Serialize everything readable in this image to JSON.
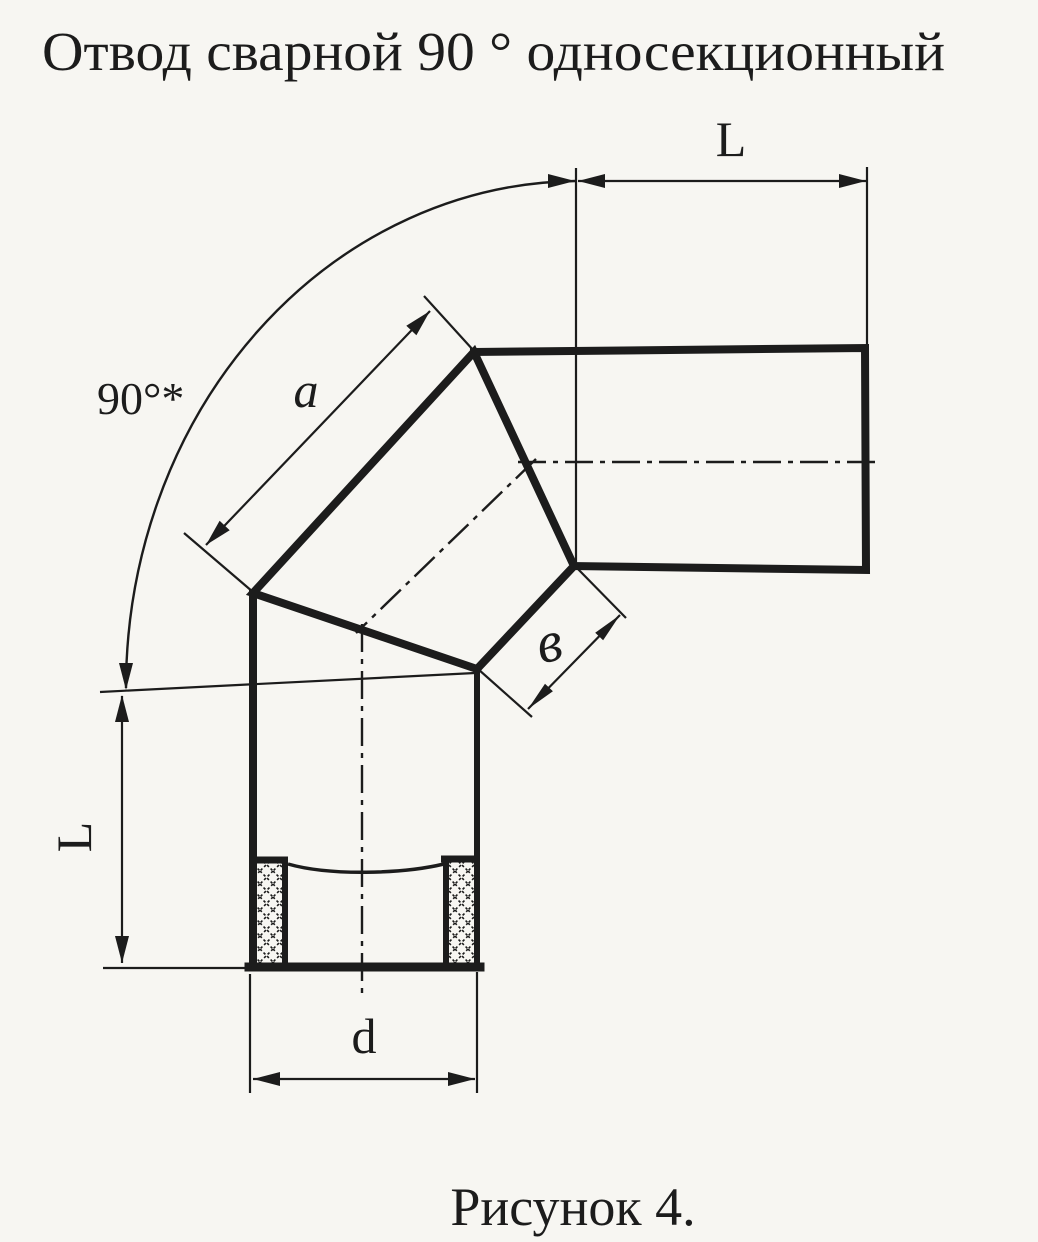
{
  "title": "Отвод сварной 90 ° односекционный",
  "caption": "Рисунок 4.",
  "dimensions": {
    "angle_label": "90°*",
    "top_length_label": "L",
    "left_length_label": "L",
    "outer_section_label": "a",
    "inner_section_label": "в",
    "diameter_label": "d"
  },
  "colors": {
    "ink": "#1c1c1c",
    "paper": "#f7f6f2"
  }
}
